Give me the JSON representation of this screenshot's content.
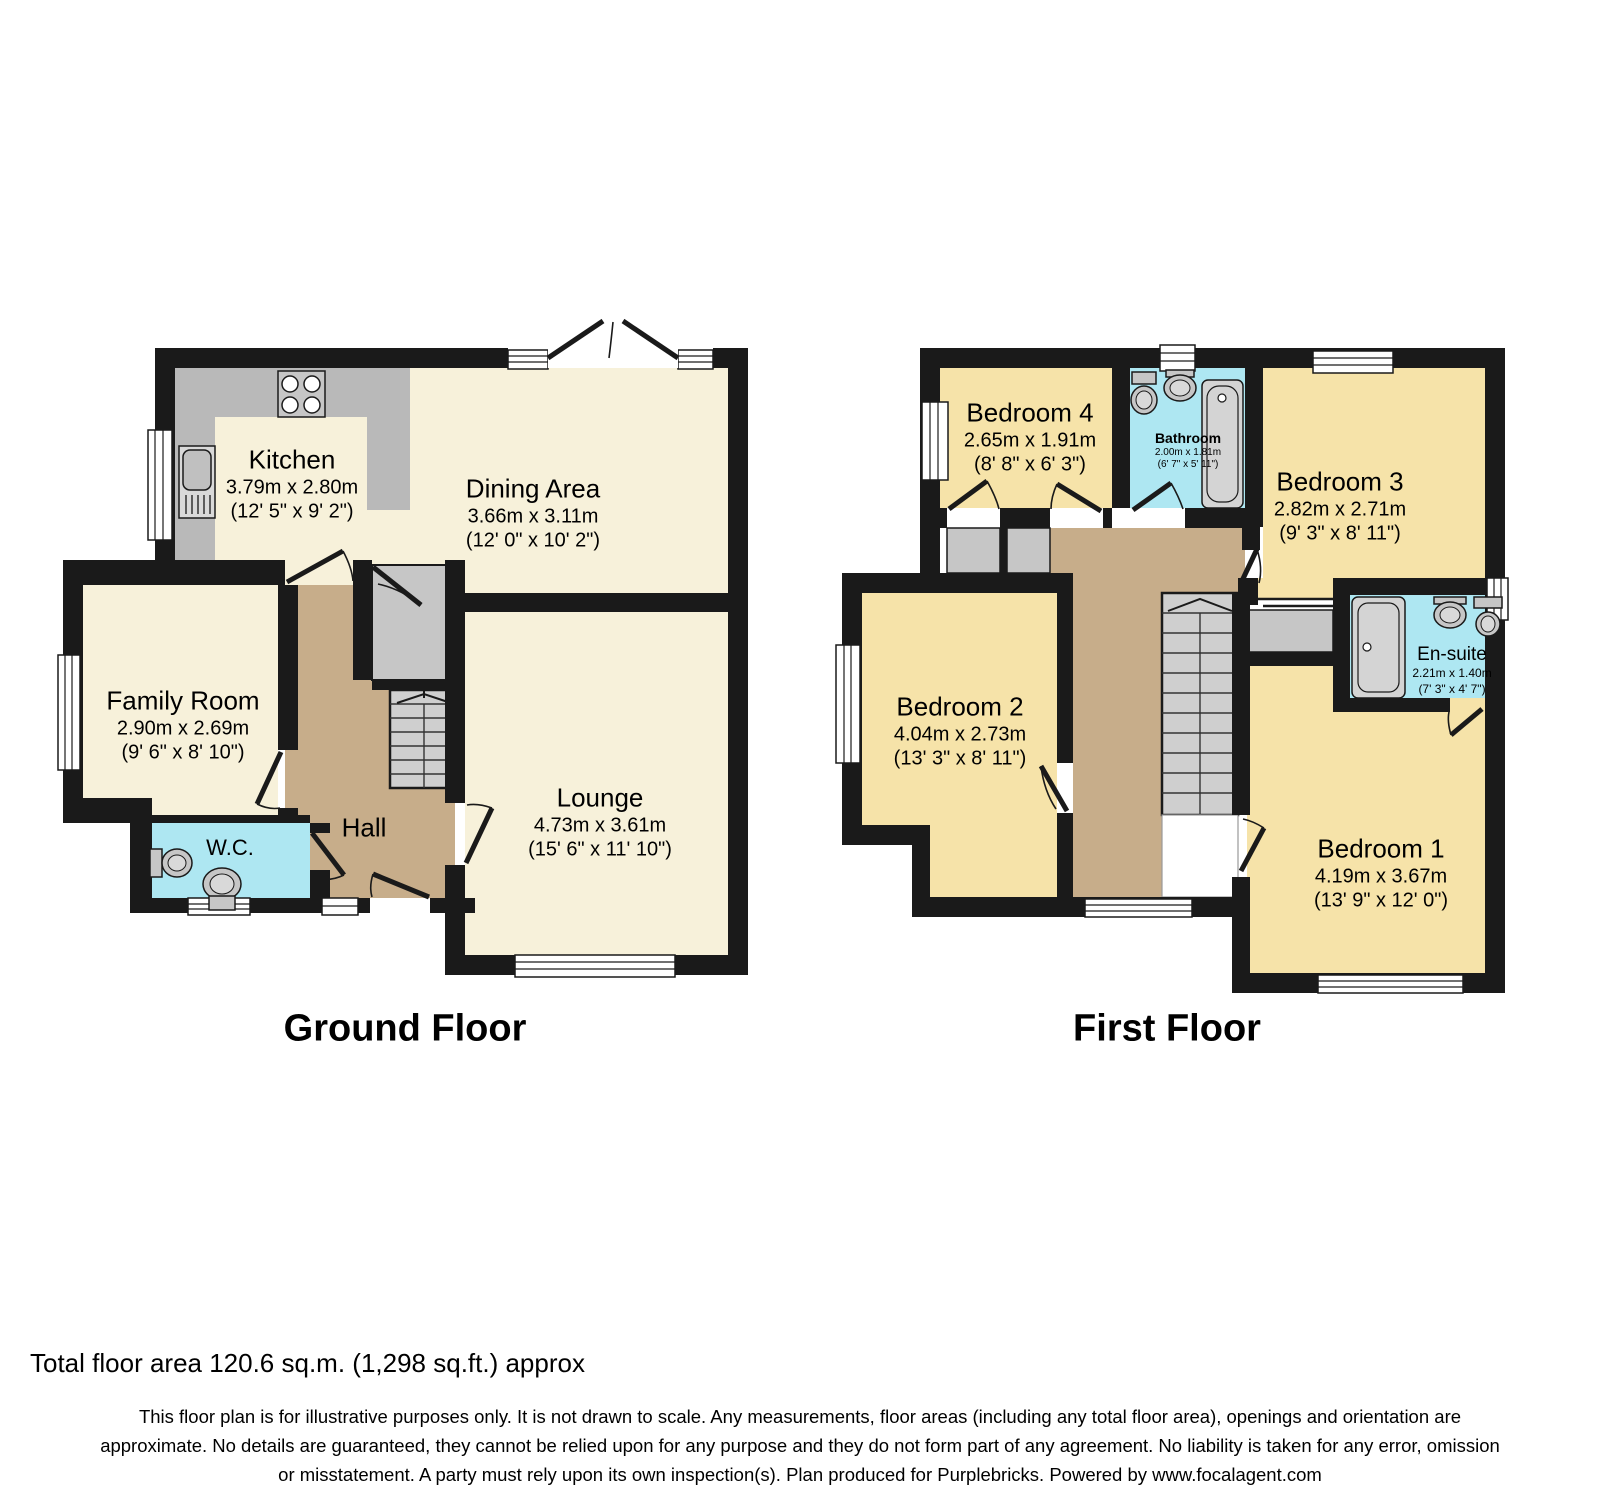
{
  "ground_floor": {
    "title": "Ground Floor",
    "rooms": {
      "kitchen": {
        "name": "Kitchen",
        "metric": "3.79m x 2.80m",
        "imperial": "(12' 5\" x 9' 2\")"
      },
      "dining_area": {
        "name": "Dining Area",
        "metric": "3.66m x 3.11m",
        "imperial": "(12' 0\" x 10' 2\")"
      },
      "family_room": {
        "name": "Family Room",
        "metric": "2.90m x 2.69m",
        "imperial": "(9' 6\" x 8' 10\")"
      },
      "wc": {
        "name": "W.C."
      },
      "hall": {
        "name": "Hall"
      },
      "lounge": {
        "name": "Lounge",
        "metric": "4.73m x 3.61m",
        "imperial": "(15' 6\" x 11' 10\")"
      }
    }
  },
  "first_floor": {
    "title": "First Floor",
    "rooms": {
      "bedroom4": {
        "name": "Bedroom 4",
        "metric": "2.65m x 1.91m",
        "imperial": "(8' 8\" x 6' 3\")"
      },
      "bathroom": {
        "name": "Bathroom",
        "metric": "2.00m x 1.81m",
        "imperial": "(6' 7\" x 5' 11\")"
      },
      "bedroom3": {
        "name": "Bedroom 3",
        "metric": "2.82m x 2.71m",
        "imperial": "(9' 3\" x 8' 11\")"
      },
      "bedroom2": {
        "name": "Bedroom 2",
        "metric": "4.04m x 2.73m",
        "imperial": "(13' 3\" x 8' 11\")"
      },
      "ensuite": {
        "name": "En-suite",
        "metric": "2.21m x 1.40m",
        "imperial": "(7' 3\" x 4' 7\")"
      },
      "bedroom1": {
        "name": "Bedroom 1",
        "metric": "4.19m x 3.67m",
        "imperial": "(13' 9\" x 12' 0\")"
      }
    }
  },
  "footer": {
    "total_area": "Total floor area 120.6 sq.m. (1,298 sq.ft.) approx",
    "disclaimer": [
      "This floor plan is for illustrative purposes only. It is not drawn to scale. Any measurements, floor areas (including any total floor area), openings and orientation are",
      "approximate. No details are guaranteed, they cannot be relied upon for any purpose and they do not form part of any agreement. No liability is taken for any error, omission",
      "or misstatement. A party must rely upon its own inspection(s). Plan produced for Purplebricks. Powered by www.focalagent.com"
    ]
  },
  "colors": {
    "wall": "#1a1a1a",
    "room_cream": "#f7f1da",
    "room_yellow": "#f6e3a9",
    "hall_tan": "#c7ad8a",
    "wet_cyan": "#aee7f2",
    "fixture_gray": "#c6c6c6"
  }
}
